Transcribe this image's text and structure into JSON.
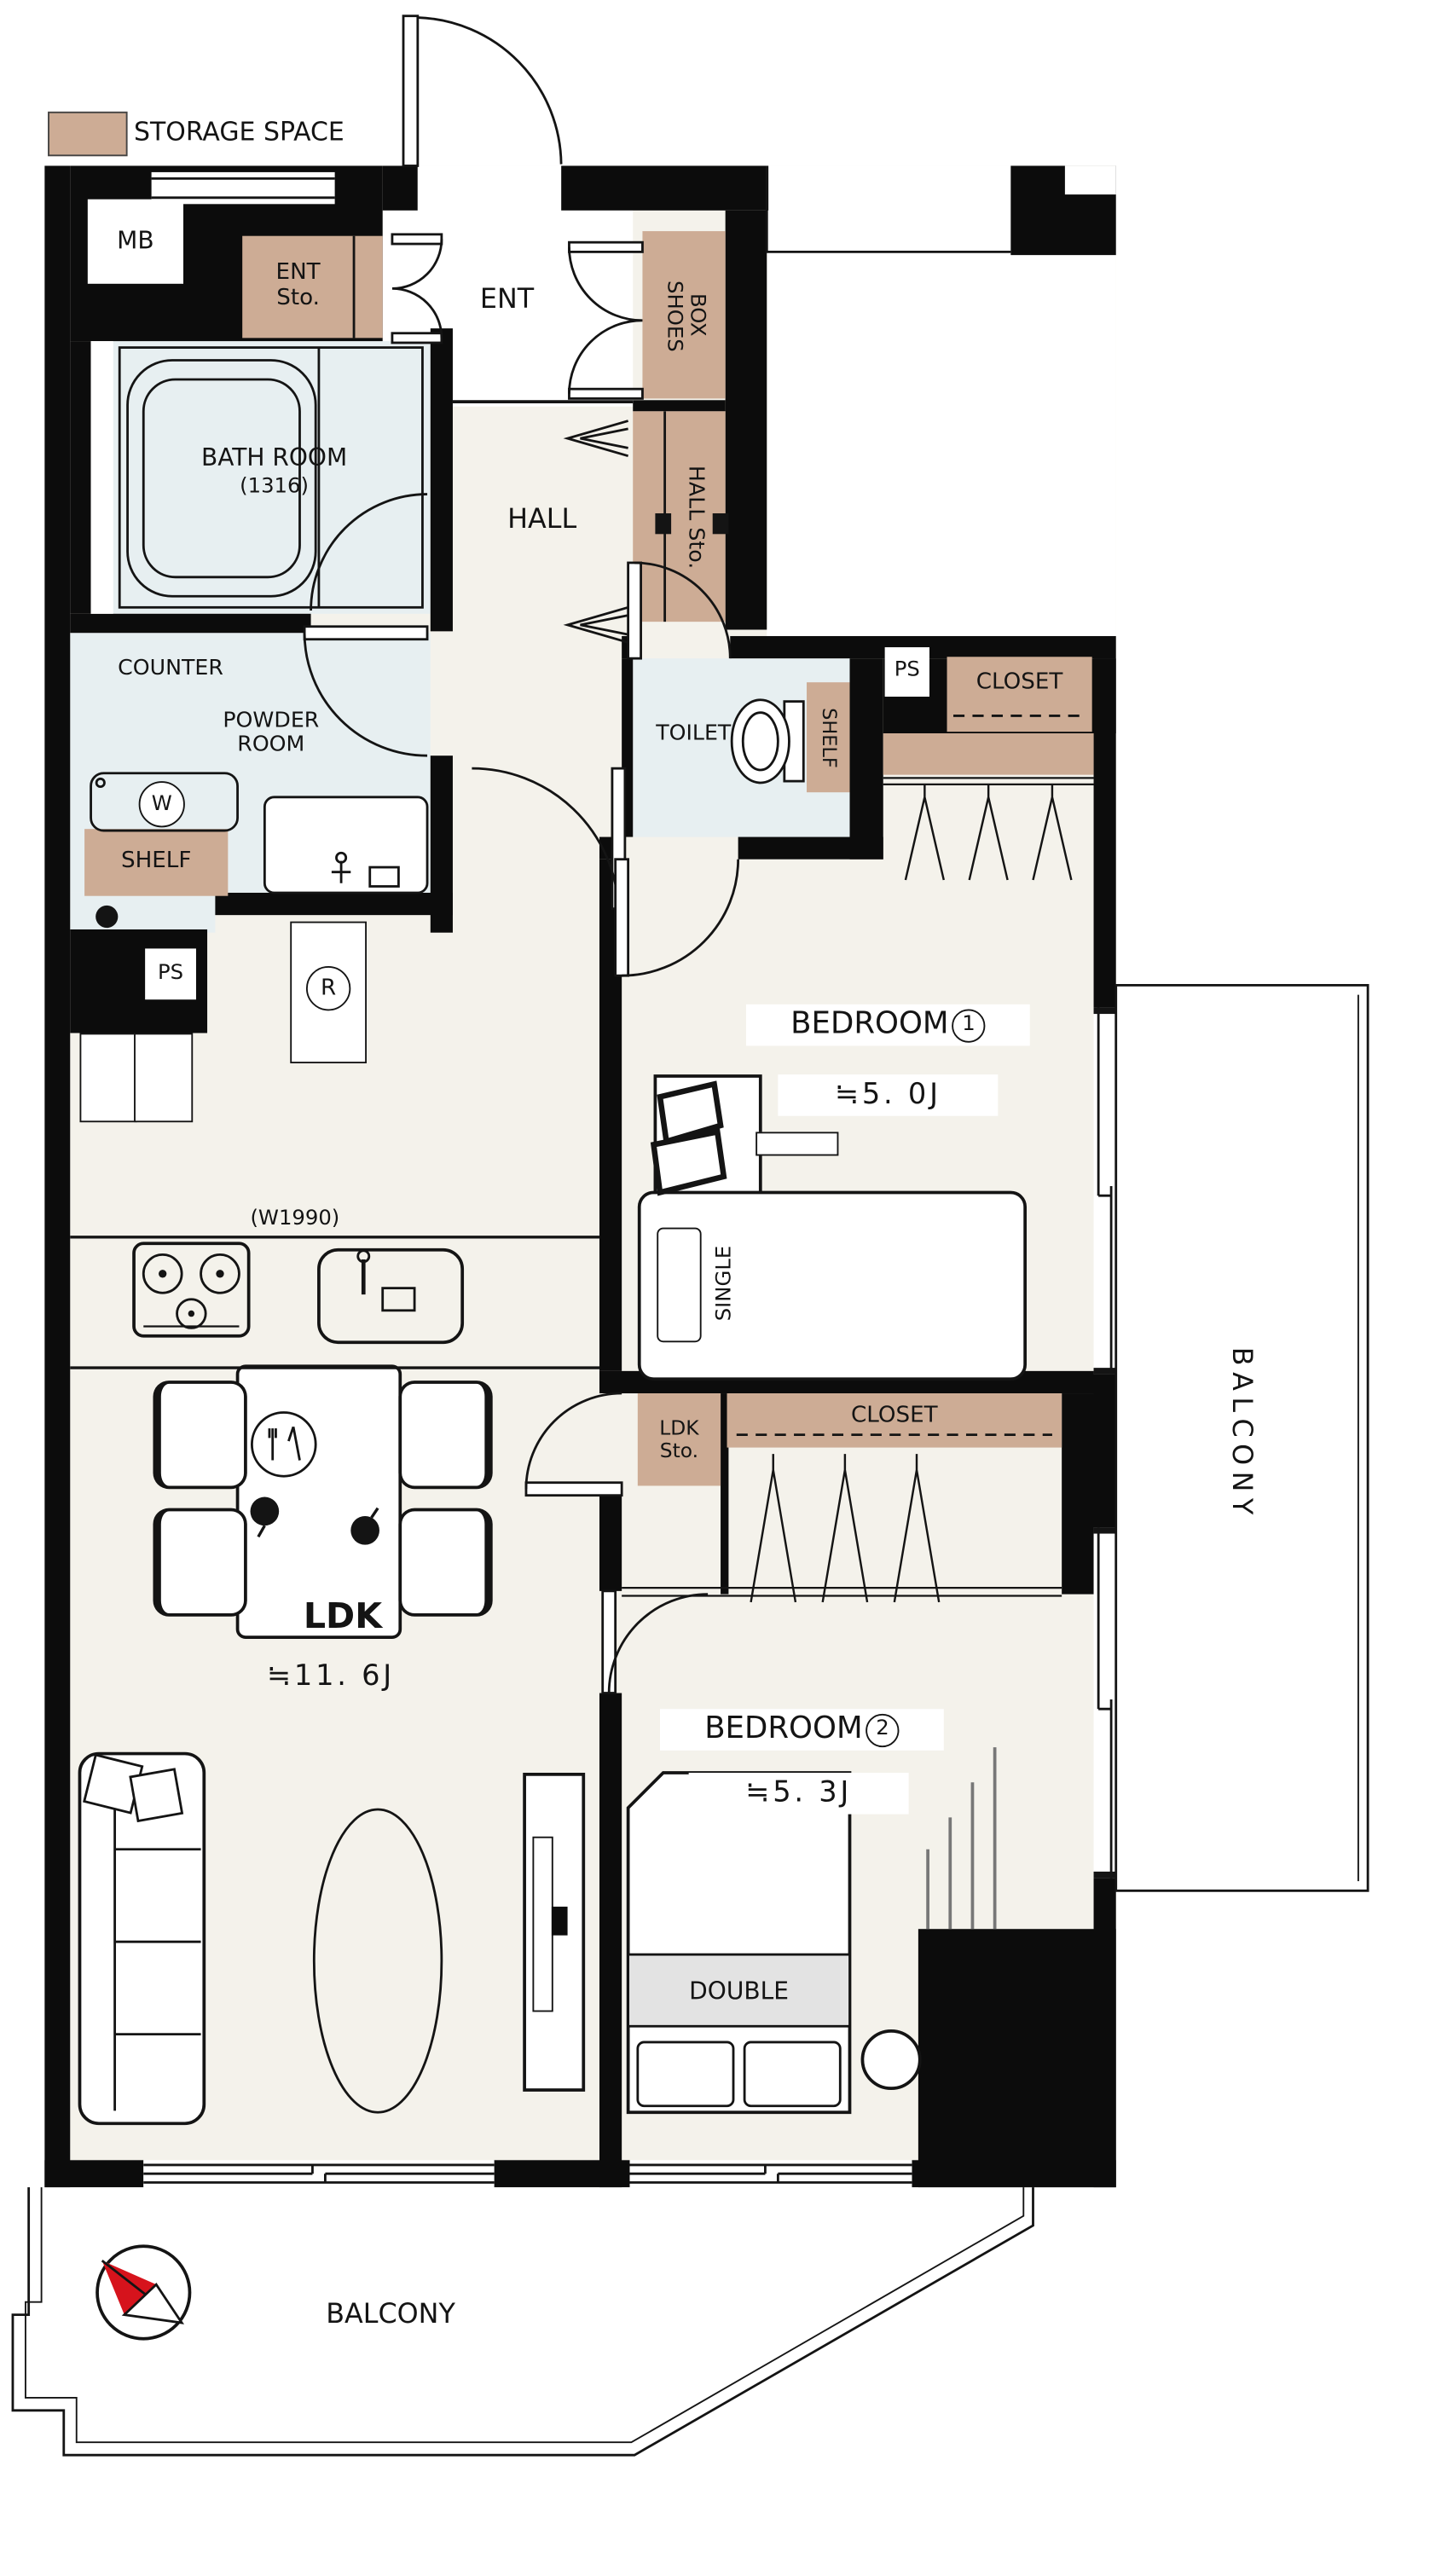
{
  "legend": {
    "label": "STORAGE SPACE"
  },
  "colors": {
    "storage": "#cdac95",
    "wet_room": "#e7eff1",
    "floor": "#f4f2eb",
    "wall": "#0c0c0c",
    "bed_footer": "#e3e3e3",
    "compass_red": "#d6131c"
  },
  "rooms": {
    "mb": "MB",
    "ent_sto": "ENT\nSto.",
    "ent": "ENT",
    "shoes_box": "SHOES\nBOX",
    "bath": "BATH ROOM",
    "bath_size": "(1316)",
    "hall": "HALL",
    "hall_sto": "HALL Sto.",
    "counter": "COUNTER",
    "powder": "POWDER\nROOM",
    "toilet": "TOILET",
    "shelf_powder": "SHELF",
    "shelf_toilet": "SHELF",
    "ps_left": "PS",
    "ps_right": "PS",
    "closet_bedroom1": "CLOSET",
    "closet_mid": "CLOSET",
    "ldk_sto": "LDK\nSto.",
    "bedroom1": "BEDROOM",
    "bedroom1_num": "1",
    "bedroom1_size": "≒5. 0J",
    "bedroom2": "BEDROOM",
    "bedroom2_num": "2",
    "bedroom2_size": "≒5. 3J",
    "ldk": "LDK",
    "ldk_size": "≒11. 6J",
    "kitchen_width": "(W1990)",
    "single_bed": "SINGLE",
    "double_bed": "DOUBLE",
    "balcony_right": "BALCONY",
    "balcony_bottom": "BALCONY",
    "washer": "W",
    "fridge": "R"
  }
}
